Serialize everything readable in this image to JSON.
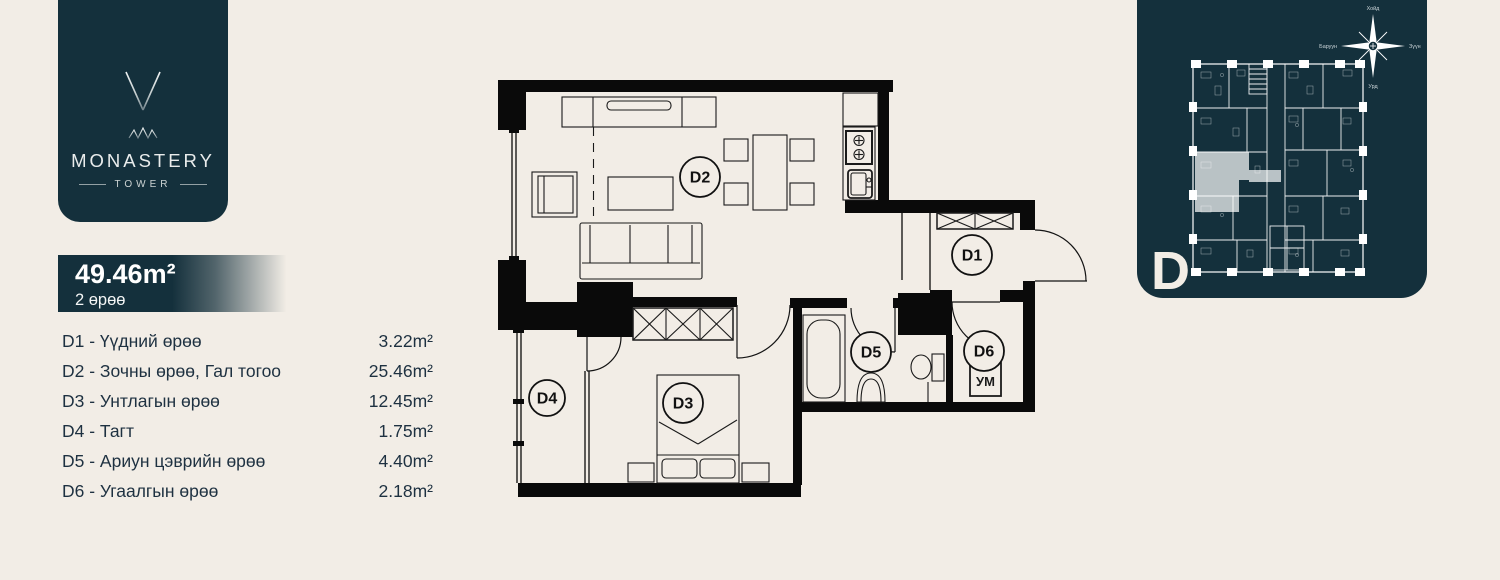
{
  "logo": {
    "brand": "MONASTERY",
    "sub": "TOWER"
  },
  "summary": {
    "area": "49.46m²",
    "rooms": "2 өрөө"
  },
  "rooms": [
    {
      "label": "D1 - Үүдний өрөө",
      "area": "3.22m²"
    },
    {
      "label": "D2 - Зочны өрөө, Гал тогоо",
      "area": "25.46m²"
    },
    {
      "label": "D3 - Унтлагын өрөө",
      "area": "12.45m²"
    },
    {
      "label": "D4 - Тагт",
      "area": "1.75m²"
    },
    {
      "label": "D5 - Ариун цэврийн өрөө",
      "area": "4.40m²"
    },
    {
      "label": "D6 - Угаалгын өрөө",
      "area": "2.18m²"
    }
  ],
  "plan": {
    "labels": {
      "d1": "D1",
      "d2": "D2",
      "d3": "D3",
      "d4": "D4",
      "d5": "D5",
      "d6": "D6"
    },
    "washer": "УМ"
  },
  "key_panel": {
    "letter": "D",
    "compass": {
      "north": "Хойд",
      "west": "Баруун",
      "east": "Зүүн",
      "south": "Урд"
    }
  },
  "colors": {
    "background": "#f2ede6",
    "panel": "#14303c",
    "ink": "#1e3141",
    "plan_line": "#0a0a0a",
    "highlight": "#c2cacd",
    "silver": "#d9dddd"
  }
}
